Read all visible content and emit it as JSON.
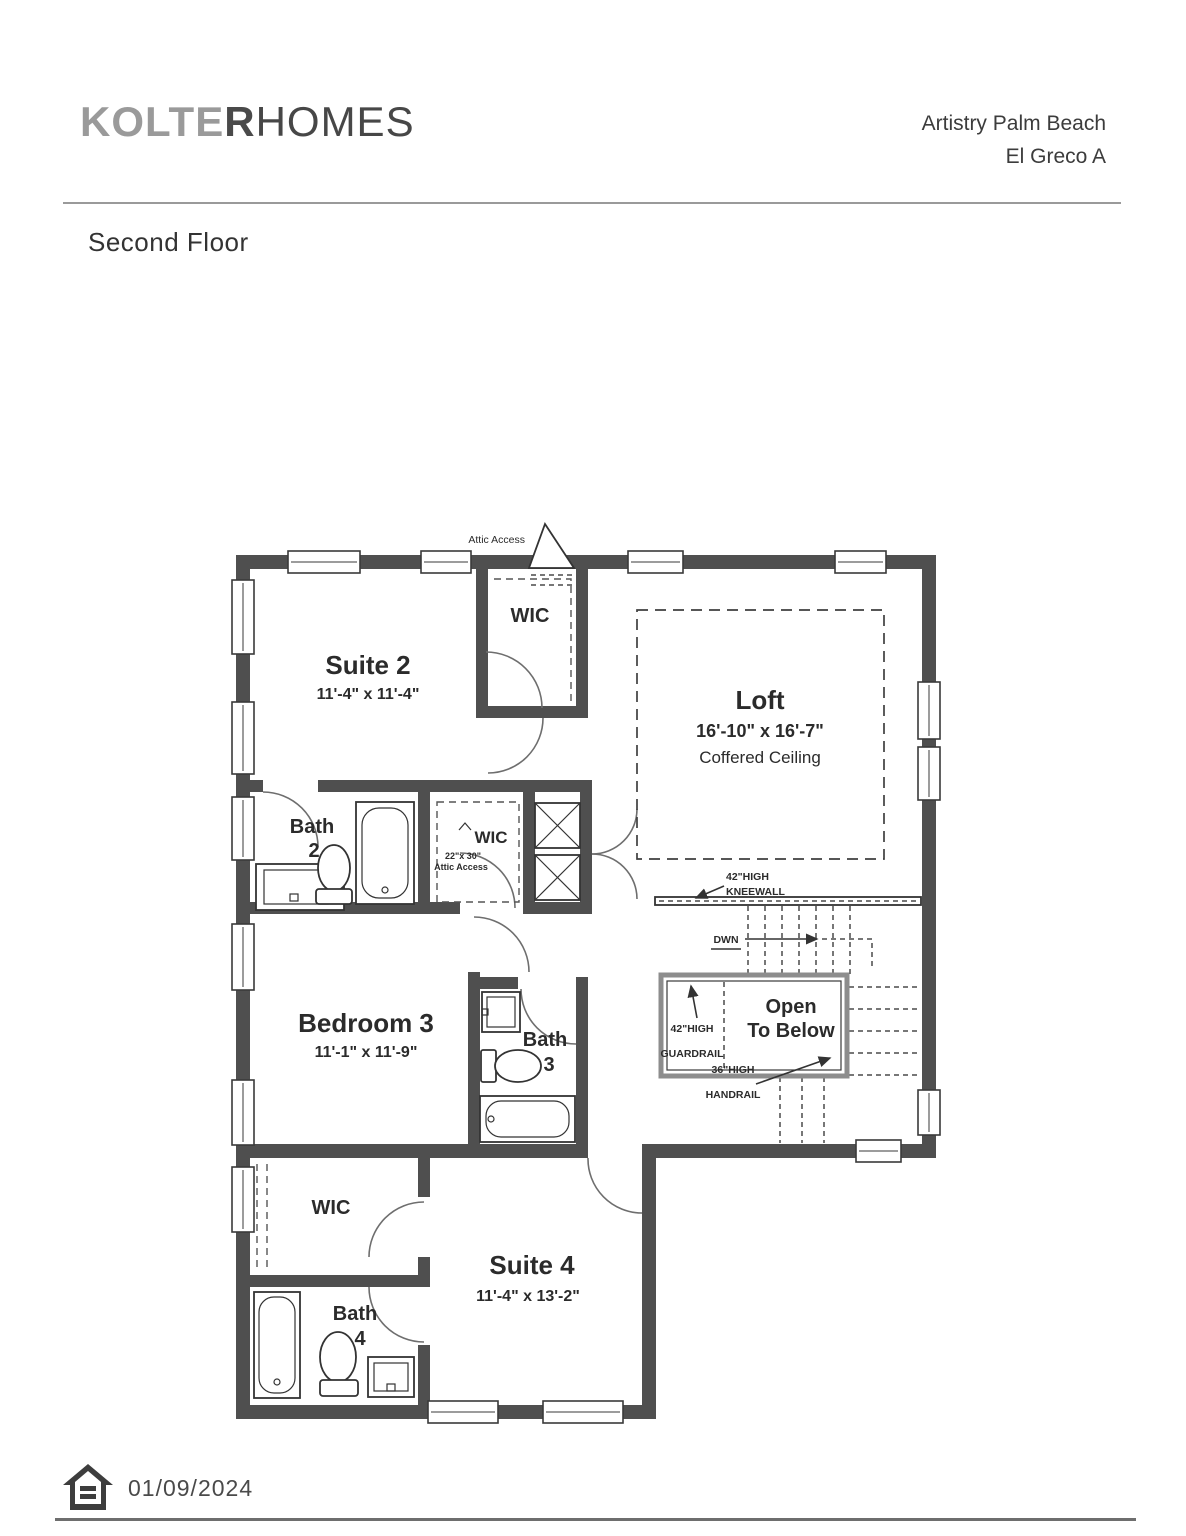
{
  "header": {
    "logo_kolter": "KOLTE",
    "logo_r": "R",
    "logo_homes": "HOMES",
    "community": "Artistry Palm Beach",
    "model": "El Greco A"
  },
  "title": "Second Floor",
  "plan": {
    "attic_access": "Attic Access",
    "suite2": {
      "name": "Suite 2",
      "dims": "11'-4\" x 11'-4\""
    },
    "wic_top": {
      "name": "WIC"
    },
    "loft": {
      "name": "Loft",
      "dims": "16'-10\" x 16'-7\"",
      "ceiling": "Coffered Ceiling"
    },
    "bath2": {
      "name": "Bath",
      "num": "2"
    },
    "wic_mid": {
      "name": "WIC",
      "attic_line1": "22\"x 30\"",
      "attic_line2": "Attic Access"
    },
    "kneewall": {
      "line1": "42\"HIGH",
      "line2": "KNEEWALL"
    },
    "stairs": {
      "down": "DWN"
    },
    "bedroom3": {
      "name": "Bedroom 3",
      "dims": "11'-1\" x 11'-9\""
    },
    "bath3": {
      "name": "Bath",
      "num": "3"
    },
    "open_below": {
      "line1": "Open",
      "line2": "To Below"
    },
    "guardrail": {
      "line1": "42\"HIGH",
      "line2": "GUARDRAIL"
    },
    "handrail": {
      "line1": "36\"HIGH",
      "line2": "HANDRAIL"
    },
    "wic_bottom": {
      "name": "WIC"
    },
    "suite4": {
      "name": "Suite 4",
      "dims": "11'-4\" x 13'-2\""
    },
    "bath4": {
      "name": "Bath",
      "num": "4"
    }
  },
  "footer": {
    "date": "01/09/2024",
    "icon": "equal-housing-logo"
  },
  "colors": {
    "wall": "#4f4f4f",
    "ink": "#2b2b2b",
    "logo_gray": "#9a9a9a",
    "logo_dark": "#474747"
  }
}
